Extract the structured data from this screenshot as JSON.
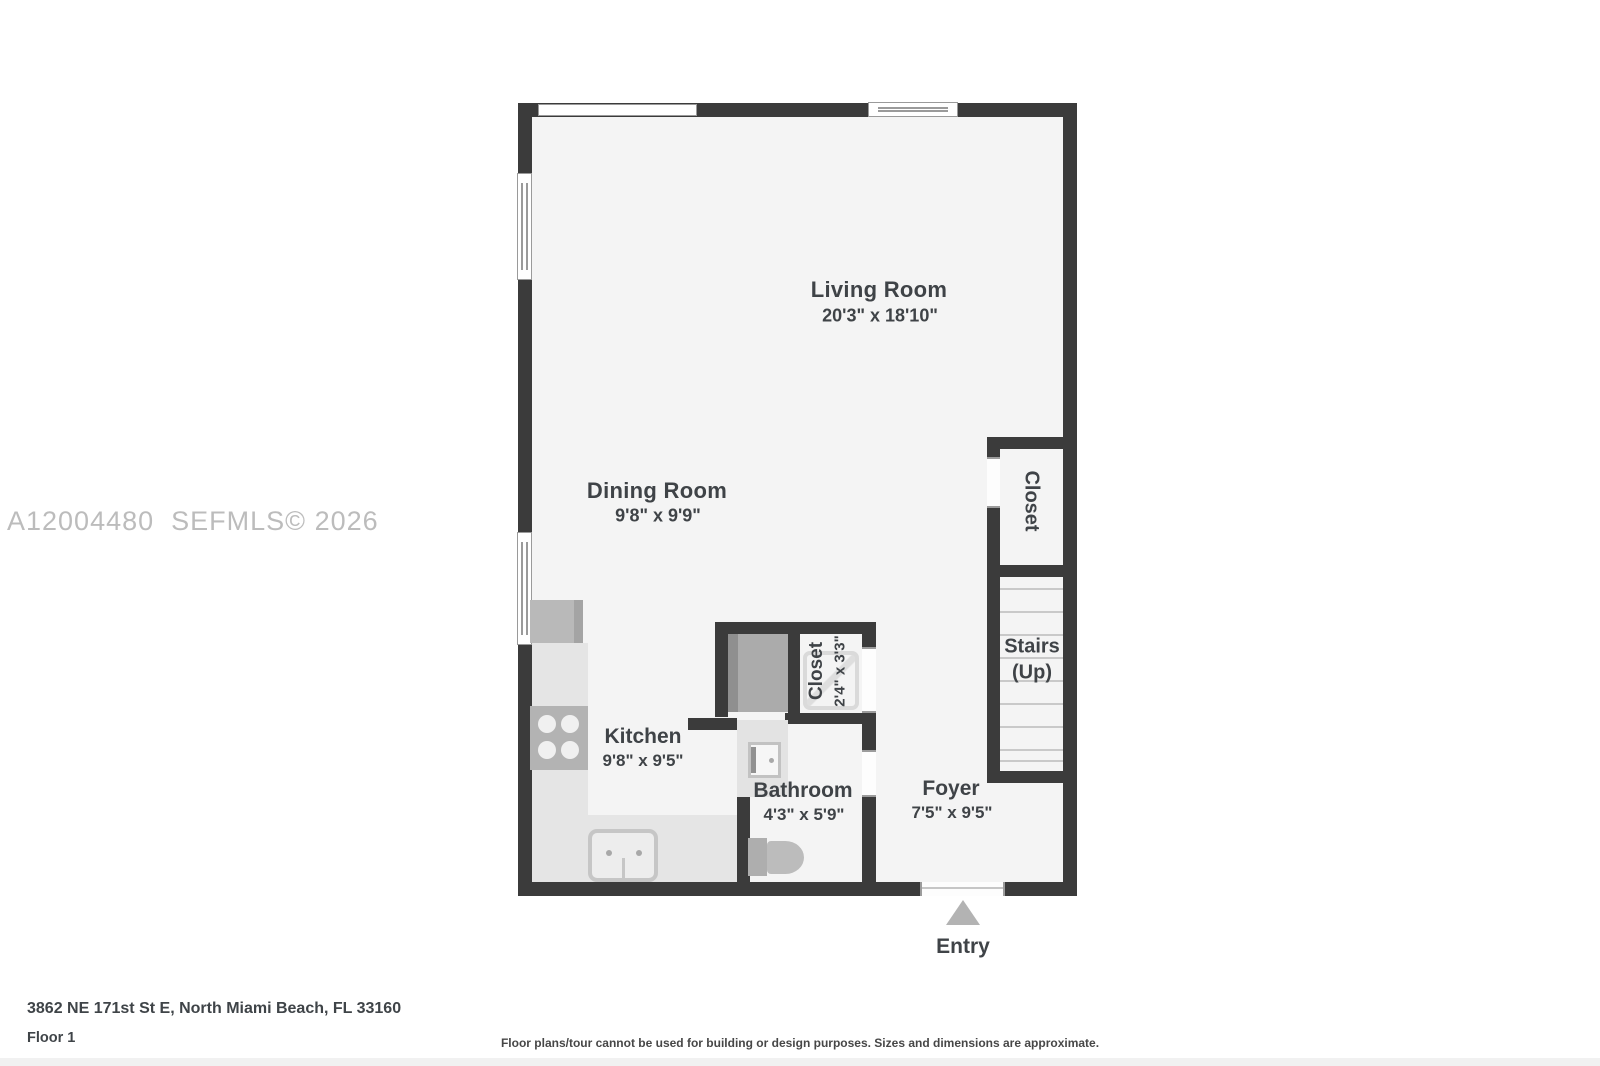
{
  "watermark": {
    "text": "A12004480  SEFMLS© 2026"
  },
  "rooms": {
    "living": {
      "name": "Living Room",
      "dims": "20'3\" x 18'10\""
    },
    "dining": {
      "name": "Dining Room",
      "dims": "9'8\" x 9'9\""
    },
    "kitchen": {
      "name": "Kitchen",
      "dims": "9'8\" x 9'5\""
    },
    "bathroom": {
      "name": "Bathroom",
      "dims": "4'3\" x 5'9\""
    },
    "closet_small": {
      "name": "Closet",
      "dims": "2'4\" x 3'3\""
    },
    "closet_entry": {
      "name": "Closet"
    },
    "stairs": {
      "name": "Stairs",
      "sub": "(Up)"
    },
    "foyer": {
      "name": "Foyer",
      "dims": "7'5\" x 9'5\""
    },
    "entry": {
      "name": "Entry"
    }
  },
  "footer": {
    "address": "3862 NE 171st St E, North Miami Beach, FL 33160",
    "floor": "Floor 1",
    "disclaimer": "Floor plans/tour cannot be used for building or design purposes. Sizes and dimensions are approximate."
  },
  "colors": {
    "wall": "#3b3b3b",
    "floor": "#f4f4f4",
    "counter": "#e5e5e5",
    "fixture": "#b5b5b5",
    "watermark": "#bcbcbc",
    "text": "#3f4347"
  }
}
